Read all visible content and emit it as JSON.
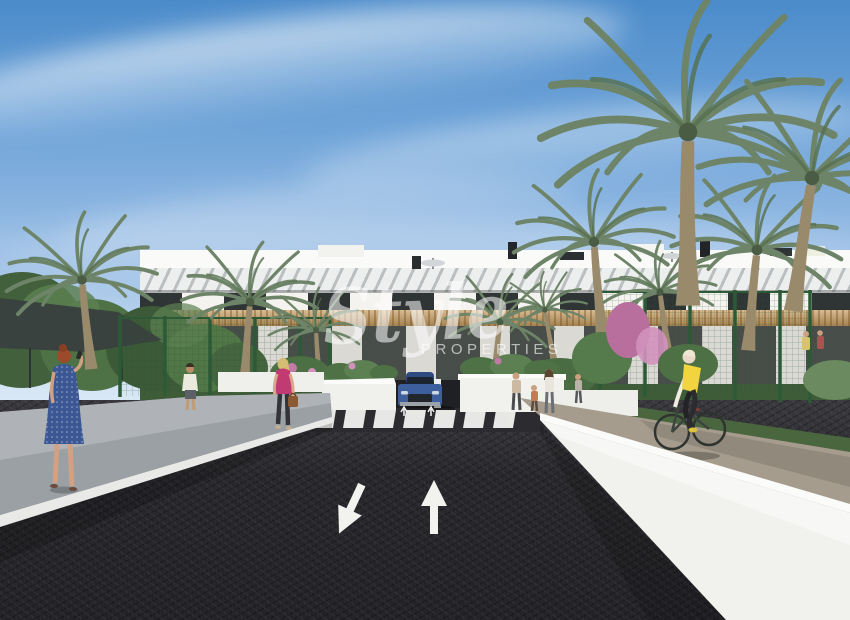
{
  "meta": {
    "image_type": "architectural-render",
    "subject": "new-build apartment development street view"
  },
  "watermark": {
    "brand": "Style",
    "subtitle": "PROPERTIES"
  },
  "colors": {
    "skyTop": "#4b8bca",
    "skyHorizon": "#e2eef7",
    "facade": "#f6f5f1",
    "wood": "#c69e63",
    "windowGlass": "#2f3434",
    "palmFrond": "#6e8468",
    "palmTrunk": "#9a8a6c",
    "foliageDark": "#3f5c39",
    "foliageLight": "#5d8052",
    "bougainvillea": "#c17ba6",
    "road": "#27272b",
    "roadMarking": "#f2f2ef",
    "curbGray": "#9aa0a4",
    "wallWhite": "#f1f1ee",
    "pavement": "#a69c8e",
    "carBlue": "#3d5f9d",
    "dressBlue": "#3b5794",
    "hairRed": "#9c4a2c",
    "topPink": "#c23a72",
    "vestYellow": "#f1d440",
    "fenceGreen": "#2d5a36",
    "canopyDark": "#39423e"
  },
  "scene": {
    "elements": [
      "blue sky with wispy clouds",
      "white two-storey apartment block with wood pergolas",
      "palm trees",
      "green mesh fence",
      "zebra crosswalk",
      "blue SUV at garage entrance",
      "asphalt road with two lane arrows",
      "woman in blue dress on phone",
      "man in white shirt",
      "woman in pink top with handbag",
      "pedestrians on right sidewalk",
      "cyclist in yellow vest"
    ],
    "road_markings": [
      "arrow-toward-viewer-icon",
      "arrow-away-icon",
      "zebra-crossing-stripes"
    ]
  }
}
